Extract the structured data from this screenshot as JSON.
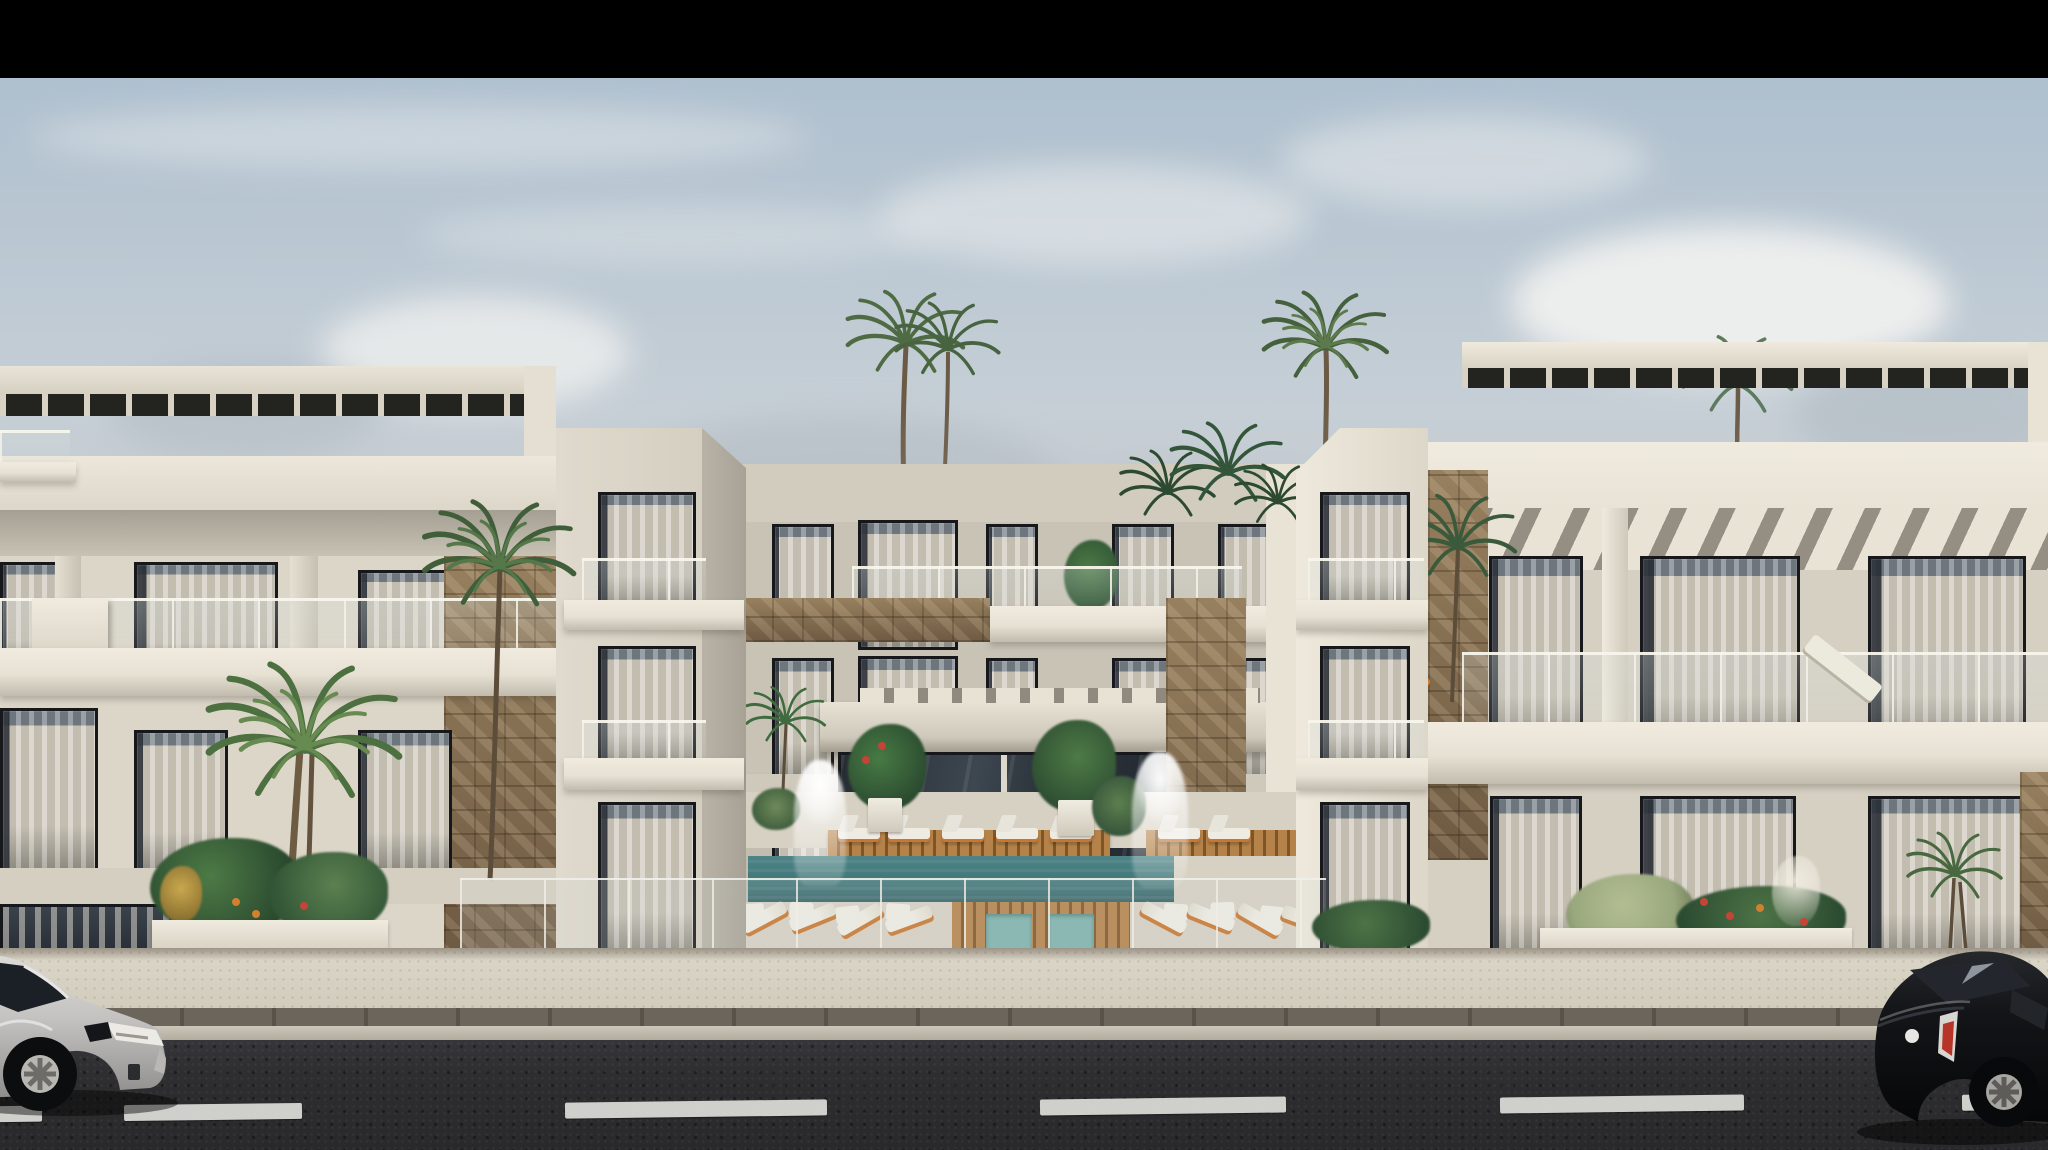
{
  "scene": {
    "title": "Photorealistic exterior rendering of a modern white apartment complex",
    "description": "Street-level elevation view of a three-storey cream apartment complex with rooftop pergolas, glass balcony balustrades, stone accent cladding, a central courtyard swimming pool with wooden sun decks, white sun loungers, fountains and tropical planting; palm trees rise above the roofline under a hazy blue sky; a silver hatchback and a black hatchback are parked on the asphalt street in the foreground; a black letterbox bar runs across the top of the frame",
    "letterbox_top": true,
    "time_of_day": "day"
  },
  "palette": {
    "black-bar": "#000000",
    "sky-top": "#a9bccd",
    "sky-mid": "#c6cfd6",
    "sky-haze": "#bcc2c7",
    "cloud-white": "#f3f3f1",
    "cloud-gray": "#aeb8c0",
    "wall-light": "#dcd6c9",
    "wall-bright": "#e9e3d6",
    "wall-mid": "#c9c3b6",
    "wall-shadow": "#a9a399",
    "trim-white": "#e7e1d4",
    "under-roof": "#8e887c",
    "ceiling-shadow": "#a59f93",
    "frame-dark": "#17181c",
    "curtain": "#cdc7ba",
    "glass-dark": "#2b323a",
    "stone-light": "#a08a6c",
    "stone-dark": "#6e5a42",
    "slat-dark": "#232420",
    "pool-teal": "#417678",
    "pool-light": "#7fb3ad",
    "wood": "#b5824a",
    "wood-dark": "#7e5526",
    "lounger-white": "#eeebe2",
    "lounger-orange": "#c9762f",
    "deck-concrete": "#d7d1c3",
    "sidewalk": "#dad4c6",
    "paver": "#6b655c",
    "curb": "#cdc7b9",
    "road": "#2e2e30",
    "road-mark": "#dcdcd8",
    "car-silver": "#c4c2c0",
    "car-black": "#101113",
    "taillight-red": "#b63428",
    "palm-green": "#4c7040",
    "palm-dark": "#2d4a31",
    "plant-green": "#3c6b40",
    "bush-sage": "#9aa87e",
    "flower-red": "#c44436",
    "flower-orange": "#d2802f",
    "fountain-white": "#f4f3ef"
  },
  "objects": {
    "buildings": [
      "left wing with rooftop pergola and stair tower",
      "recessed central block over pool courtyard",
      "right wing with slatted-shade stripes and stair tower"
    ],
    "amenities": [
      "swimming pool",
      "wooden deck platforms",
      "white sun loungers",
      "orange slatted sunbeds",
      "glass balustrade",
      "water-feature fountains",
      "entrance canopy"
    ],
    "vegetation": [
      "tall twin palms",
      "rooftop palms",
      "courtyard palms",
      "tropical planter with monstera and yucca",
      "flower bed with red and orange blooms",
      "sage green bush"
    ],
    "street": [
      "paved sidewalk",
      "paver drainage strip",
      "curb",
      "asphalt road",
      "dashed white lane markings"
    ],
    "vehicles": [
      "silver hatchback parked at left, front three-quarter view",
      "black hatchback parked at right, rear three-quarter view"
    ]
  }
}
